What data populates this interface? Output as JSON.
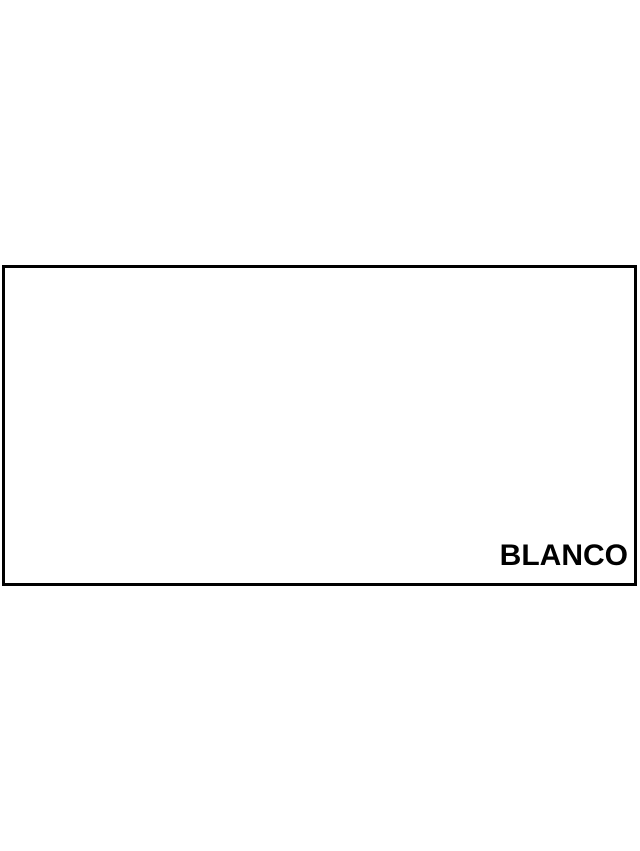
{
  "page": {
    "background": "#ffffff"
  },
  "swatch": {
    "label": "BLANCO",
    "fill": "#ffffff",
    "border": "#000000",
    "label_color": "#000000"
  }
}
